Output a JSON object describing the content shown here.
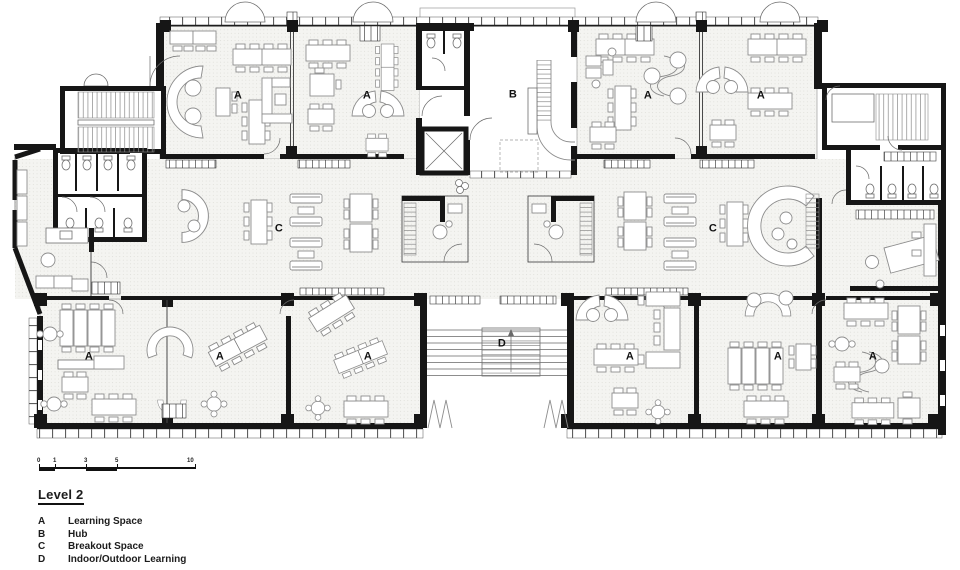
{
  "plan": {
    "labels": [
      {
        "text": "A",
        "x": 238,
        "y": 96
      },
      {
        "text": "A",
        "x": 367,
        "y": 96
      },
      {
        "text": "B",
        "x": 513,
        "y": 95
      },
      {
        "text": "A",
        "x": 648,
        "y": 96
      },
      {
        "text": "A",
        "x": 761,
        "y": 96
      },
      {
        "text": "C",
        "x": 279,
        "y": 229
      },
      {
        "text": "C",
        "x": 713,
        "y": 229
      },
      {
        "text": "A",
        "x": 89,
        "y": 357
      },
      {
        "text": "A",
        "x": 220,
        "y": 357
      },
      {
        "text": "A",
        "x": 368,
        "y": 357
      },
      {
        "text": "D",
        "x": 502,
        "y": 344
      },
      {
        "text": "A",
        "x": 630,
        "y": 357
      },
      {
        "text": "A",
        "x": 778,
        "y": 357
      },
      {
        "text": "A",
        "x": 873,
        "y": 357
      }
    ]
  },
  "scalebar": {
    "ticks": [
      "0",
      "1",
      "3",
      "5",
      "10"
    ]
  },
  "legend": {
    "title": "Level 2",
    "items": [
      {
        "key": "A",
        "label": "Learning Space"
      },
      {
        "key": "B",
        "label": "Hub"
      },
      {
        "key": "C",
        "label": "Breakout Space"
      },
      {
        "key": "D",
        "label": "Indoor/Outdoor Learning"
      }
    ]
  },
  "colors": {
    "ink": "#161616",
    "line": "#8d8d8d",
    "floor": "#f4f4f1"
  }
}
